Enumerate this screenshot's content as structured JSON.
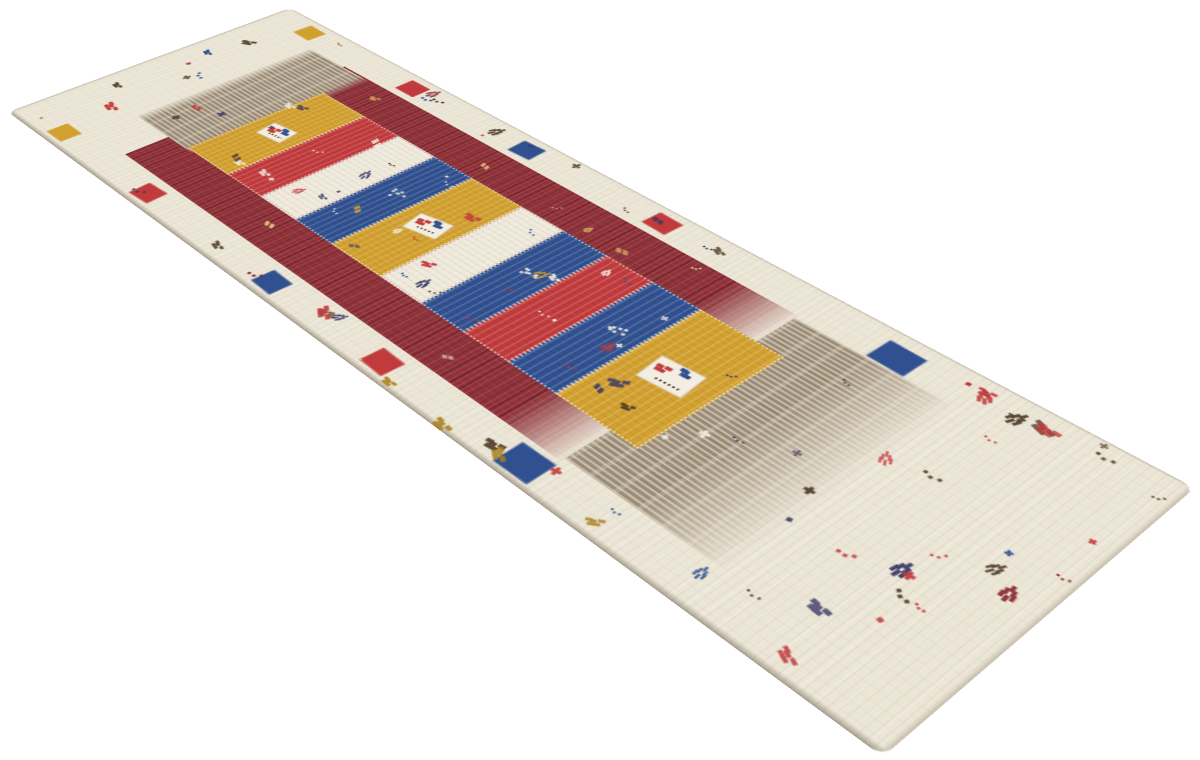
{
  "image": {
    "type": "product-photo",
    "subject": "Hand-knotted Loribaft Gabbeh wool runner rug shown at a diagonal angle on a plain white background",
    "background_color": "#ffffff"
  },
  "palette": {
    "white_bg": "#ffffff",
    "cream": "#ece6d7",
    "cream_block": "#efe9db",
    "maroon": "#8d3038",
    "gold": "#d2a02f",
    "gold_deep": "#a97f1e",
    "red": "#c13b3d",
    "blue": "#30508f",
    "taupe": "#9b8c77",
    "brown_motif": "#54412e",
    "navy_motif": "#3c3a66",
    "ivory": "#f3eee1"
  },
  "rug": {
    "style": "gabbeh-loribaft",
    "shape": "runner",
    "field_blocks": [
      "gold",
      "red",
      "cream",
      "blue",
      "gold",
      "cream",
      "blue",
      "red",
      "blue",
      "gold"
    ],
    "pictograph_boxes_on_gold_blocks": 3,
    "border_squares_top": [
      "gold",
      "red",
      "blue",
      "red",
      "blue"
    ],
    "border_squares_bottom": [
      "gold",
      "red",
      "blue",
      "red",
      "blue"
    ],
    "frame_color": "maroon",
    "end_bands": [
      "taupe",
      "taupe"
    ],
    "motifs": "scattered small tribal animal, star and plant motifs"
  }
}
